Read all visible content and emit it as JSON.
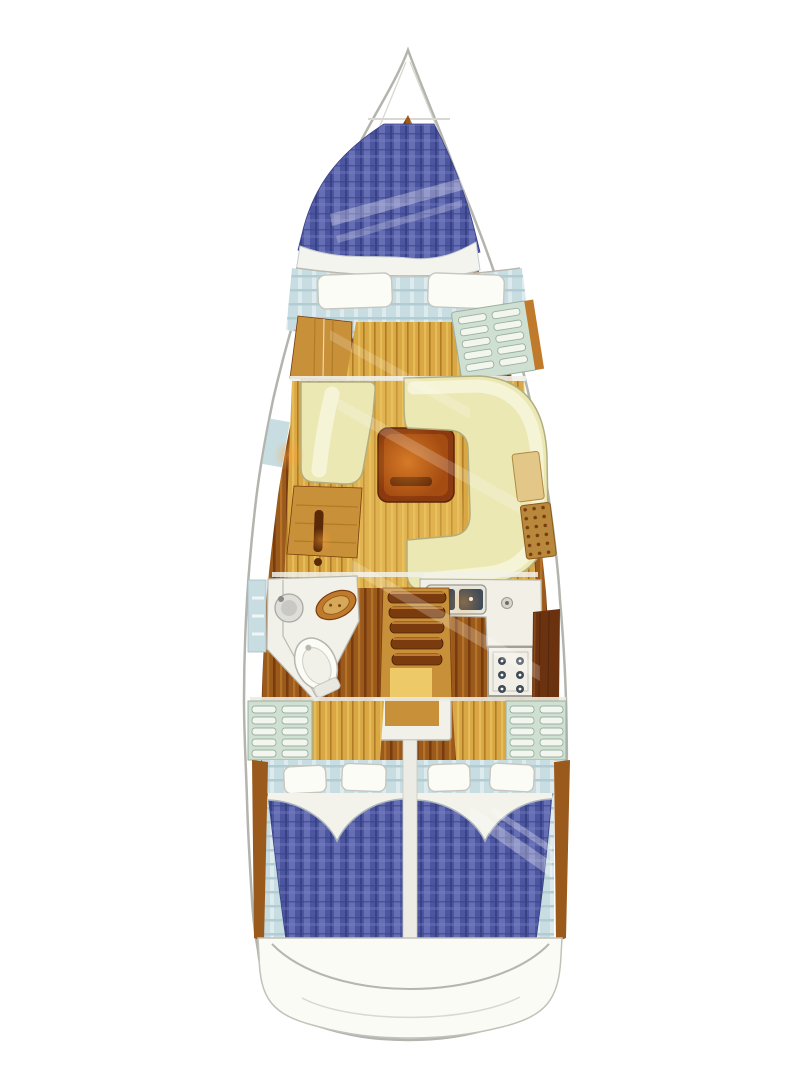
{
  "meta": {
    "title": "Sailing yacht interior layout floor plan, bow up",
    "type": "yacht-interior-floorplan",
    "visible_text": []
  },
  "areas": [
    {
      "name": "v-berth",
      "label": "forward V-berth with blue plaid mattress"
    },
    {
      "name": "forward-bench",
      "label": "forward cabin seat with two pillows"
    },
    {
      "name": "wardrobe",
      "label": "forward port wardrobe"
    },
    {
      "name": "forward-shelf",
      "label": "forward starboard slatted shelf"
    },
    {
      "name": "port-settee",
      "label": "salon port settee"
    },
    {
      "name": "nav-desk",
      "label": "port desk with handle"
    },
    {
      "name": "salon-table",
      "label": "salon wooden table"
    },
    {
      "name": "starboard-settee",
      "label": "salon U-shaped settee"
    },
    {
      "name": "side-cabinet",
      "label": "starboard caned cabinet"
    },
    {
      "name": "head",
      "label": "head with toilet and sinks"
    },
    {
      "name": "galley",
      "label": "galley with double sink and stove"
    },
    {
      "name": "companionway",
      "label": "companionway steps"
    },
    {
      "name": "mid-lockers",
      "label": "port and starboard slatted lockers"
    },
    {
      "name": "aft-cabin-port",
      "label": "port aft double berth"
    },
    {
      "name": "aft-cabin-starboard",
      "label": "starboard aft double berth"
    },
    {
      "name": "transom",
      "label": "stern transom"
    }
  ],
  "colors": {
    "hull_white": "#ffffff",
    "outline_gray": "#b4b4ae",
    "gray_line": "#b9b9b1",
    "wood_dark": "#7a3c0e",
    "wood_mid": "#9a5a1c",
    "wood_trim": "#bf7a2c",
    "wood_light": "#c89038",
    "dark_wood": "#6b3210",
    "floor_base": "#d9a844",
    "floor_line": "#b07c26",
    "floor_light": "#eec968",
    "quilt_blue": "#4c55a0",
    "quilt_light": "#7c84c2",
    "quilt_dark": "#3a4286",
    "bed_head_blue": "#c8dde2",
    "bed_head_stripe": "#b2ccd4",
    "head_light": "#e4eff1",
    "cream": "#ece8b4",
    "cream_light": "#f7f4d8",
    "cream_trim": "#b2ad7e",
    "white_soft": "#f2f1e9",
    "counter_white": "#f2f0e6",
    "pillow_white": "#fcfcf7",
    "pillow_edge": "#c6c6be",
    "locker_green": "#cfe0d2",
    "locker_slat": "#f3f6ef",
    "steel": "#414c58",
    "table_brown": "#8a3a0e",
    "table_inner": "#a54c12",
    "cane_tan": "#b8893c",
    "glow_orange": "#ffa238",
    "transom_white": "#fbfbf6"
  }
}
